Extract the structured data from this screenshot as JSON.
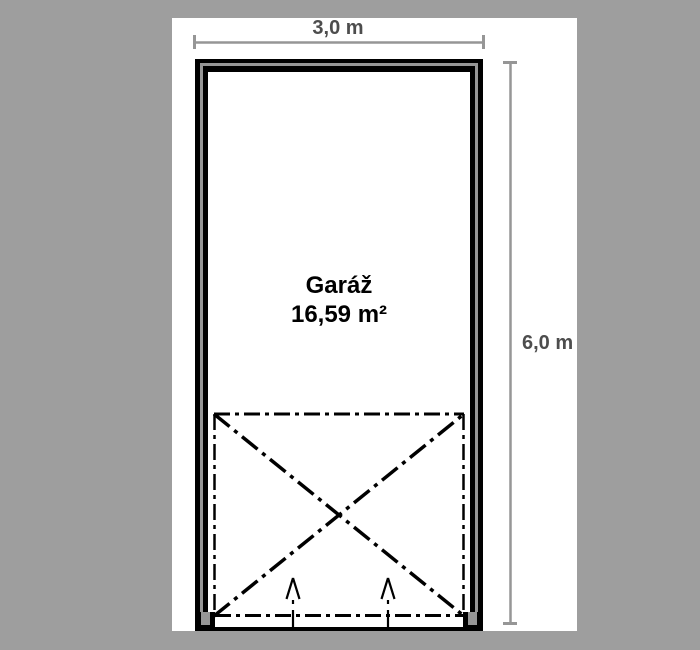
{
  "plan": {
    "room": {
      "name": "Garáž",
      "area": "16,59 m²"
    },
    "dimensions": {
      "width": "3,0 m",
      "height": "6,0 m"
    }
  },
  "colors": {
    "background": "#9e9e9e",
    "paper": "#ffffff",
    "wall": "#000000",
    "wall_core": "#969696",
    "dimension_line": "#969696",
    "dimension_text": "#4d4d4d",
    "room_text": "#000000",
    "door_symbol": "#000000"
  }
}
